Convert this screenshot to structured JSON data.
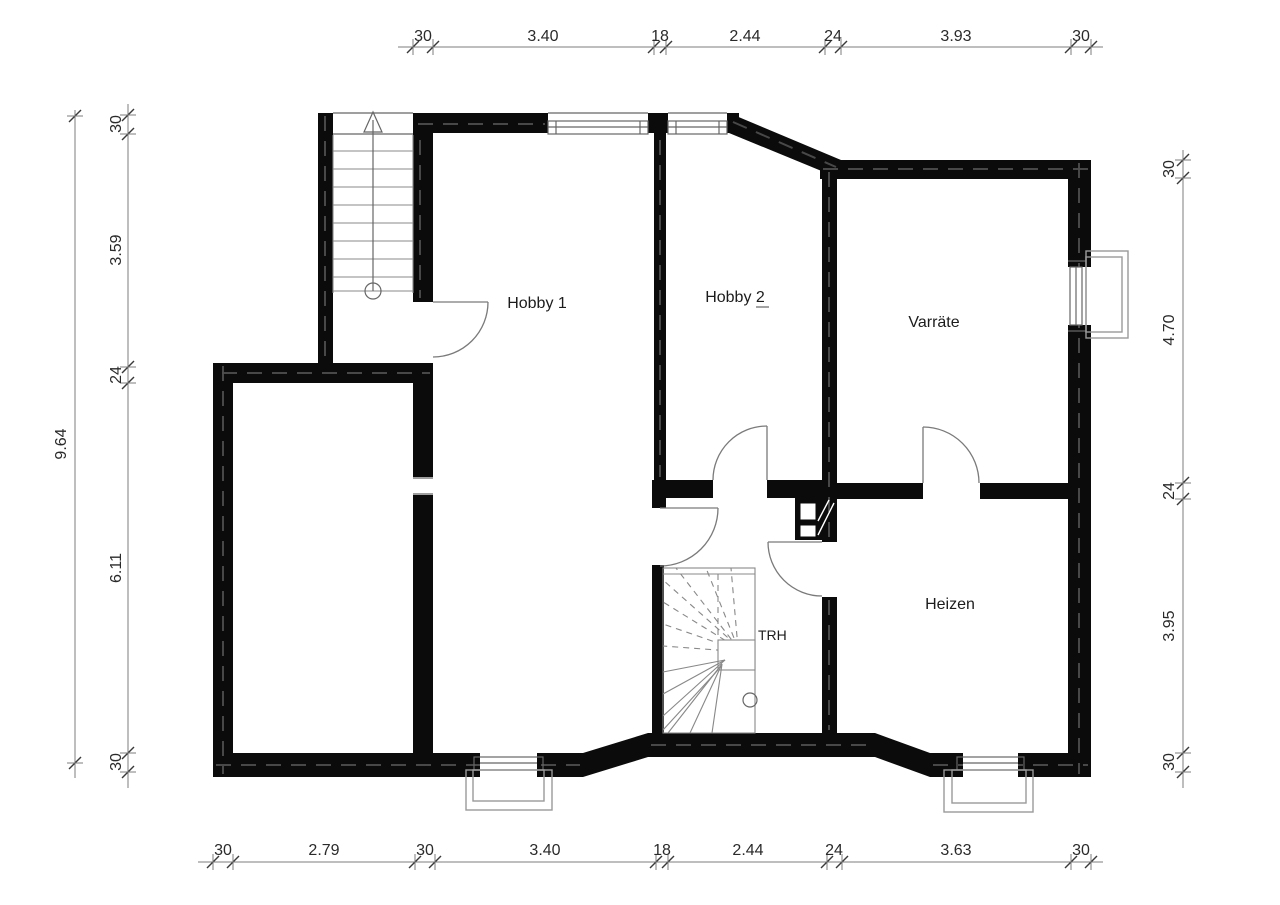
{
  "plan": {
    "rooms": {
      "hobby1": "Hobby 1",
      "hobby2": "Hobby 2",
      "varraete": "Varräte",
      "heizen": "Heizen",
      "stairwell": "TRH"
    },
    "dimensions": {
      "top": [
        "30",
        "3.40",
        "18",
        "2.44",
        "24",
        "3.93",
        "30"
      ],
      "bottom": [
        "30",
        "2.79",
        "30",
        "3.40",
        "18",
        "2.44",
        "24",
        "3.63",
        "30"
      ],
      "left": [
        "30",
        "3.59",
        "24",
        "6.11",
        "30"
      ],
      "left_total": "9.64",
      "right": [
        "30",
        "4.70",
        "24",
        "3.95",
        "30"
      ]
    },
    "colors": {
      "wall": "#0b0b0b",
      "thin_line": "#777777",
      "text": "#2a2a2a",
      "background": "#ffffff"
    }
  }
}
